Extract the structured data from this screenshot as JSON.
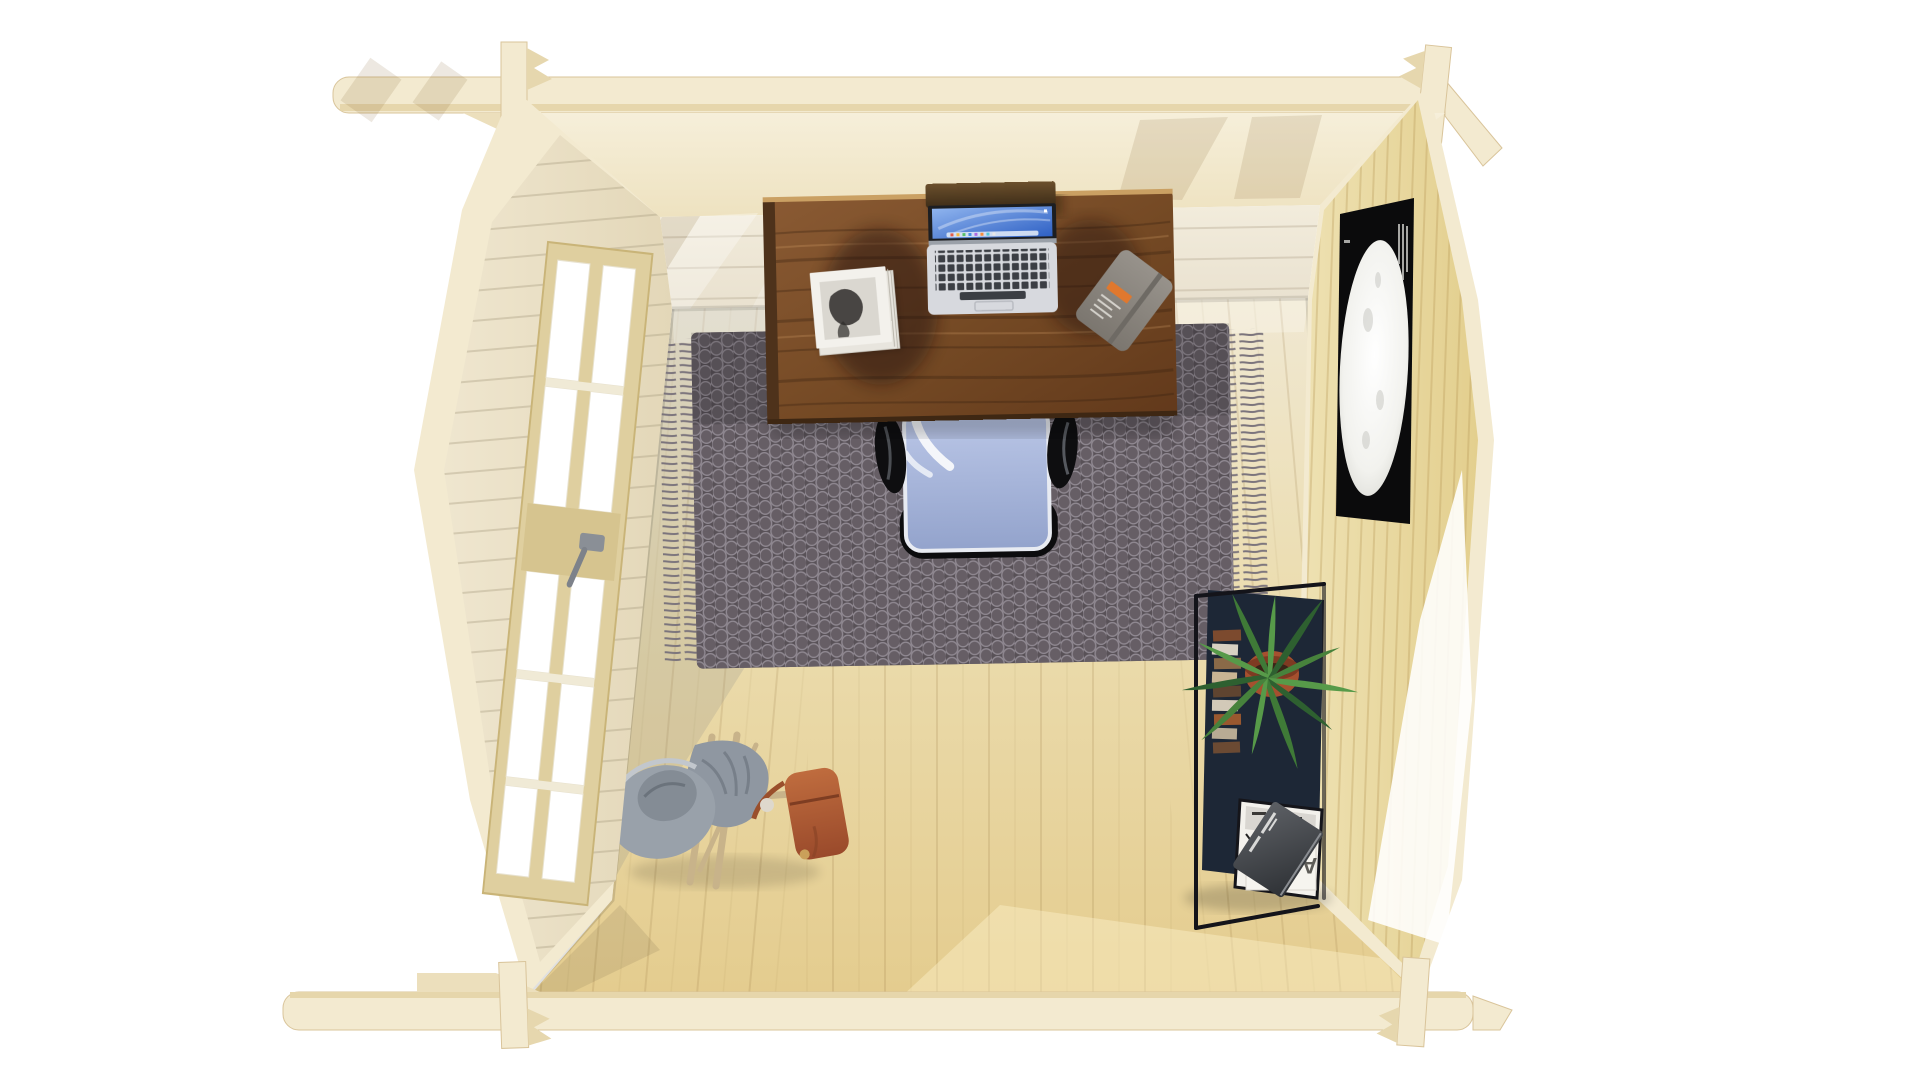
{
  "scene": {
    "title": "Top-down 3D render of a log cabin home office",
    "view": "overhead interior view, front wall removed",
    "background": "#ffffff"
  },
  "colors": {
    "background": "#ffffff",
    "timber_pale": "#f3ead0",
    "timber_edge": "#d9c49a",
    "timber_notch": "#e6d7ae",
    "wall_back_face": "#efe8d8",
    "wall_left_face": "#e8dfc6",
    "wall_right_face": "#ecdfac",
    "floor_back": "#f0e8d2",
    "floor_front": "#e4cc8e",
    "floor_shade": "#8d8f8a",
    "rug_base": "#585157",
    "rug_motif": "#938c95",
    "desk_wood": "#8a5a33",
    "desk_wood_dark": "#62391b",
    "chair_seat": "#bcc8e8",
    "chair_black": "#0c0c0e",
    "chair_frame_white": "#f4f6fa",
    "laptop_body": "#d7d9de",
    "laptop_keys": "#3b3e44",
    "laptop_screen_blue": "#2e60c4",
    "poster_bg": "#0b0b0c",
    "moon_white": "#f5f4f0",
    "plant_green": "#47823c",
    "pot_terracotta": "#a6502f",
    "shelf_panel_navy": "#1d2736",
    "shelf_frame_black": "#14141a",
    "magazine_white": "#f3f1ec",
    "notebook_grey": "#8e8a84",
    "notebook_band_orange": "#e0782e",
    "satchel_tan": "#b05c33",
    "hat_grey": "#99a1aa",
    "sticks_wood": "#c8b38a"
  },
  "structure": {
    "walls": "interlocking log walls with crossed corner joints",
    "floor": "pine plank floor",
    "lighting": "daylight through left glazing, bright wedge on right wall"
  },
  "desk": {
    "label": "walnut wood desk"
  },
  "laptop": {
    "label": "open laptop",
    "screen": "blue desktop wallpaper with dock"
  },
  "magazine_stack": {
    "label": "stack of magazines with black-and-white portrait cover"
  },
  "notebook": {
    "label": "grey planner with orange label and elastic band"
  },
  "chair": {
    "label": "task chair, pale-blue seat, black armrests and backrest"
  },
  "rug": {
    "label": "charcoal pebble-weave rug with fringed ends"
  },
  "door": {
    "label": "glazed pine door in left wall",
    "pane_columns": 2,
    "pane_rows": 5
  },
  "poster": {
    "label": "black moon art print on right wall"
  },
  "shelf": {
    "label": "black-frame shelf unit with plant, books and magazine files",
    "magazine_title": "ANDO",
    "magazine_title_note": "printed rotated 180° in this view"
  },
  "plant": {
    "label": "potted green dracaena"
  },
  "coat_stand": {
    "label": "wooden coat stand with grey hat, grey jacket and tan leather satchel"
  }
}
